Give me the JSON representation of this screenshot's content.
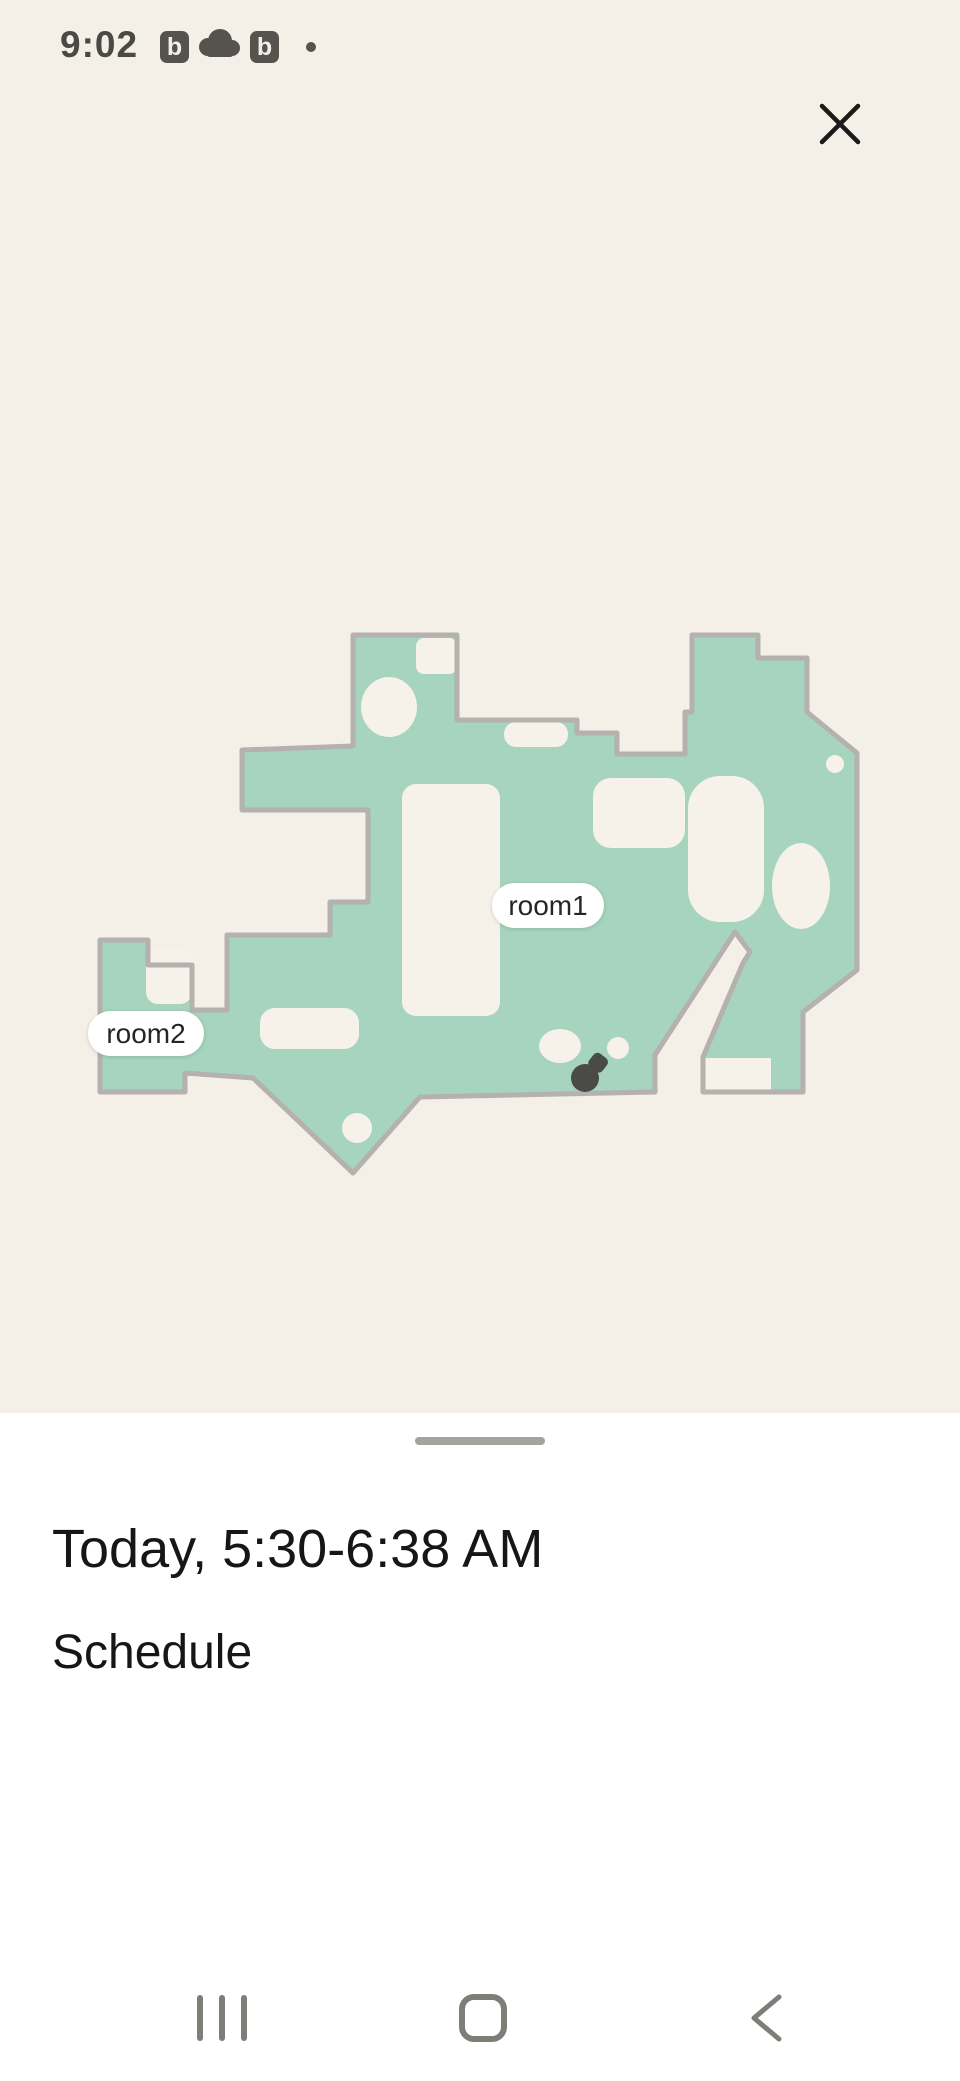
{
  "status_bar": {
    "time": "9:02",
    "badge_letter": "b",
    "wifi_generation": "6",
    "battery_percent": "93"
  },
  "map": {
    "rooms": [
      {
        "label": "room1"
      },
      {
        "label": "room2"
      }
    ],
    "colors": {
      "cleaned_area_green": "#a6d4be",
      "wall_gray": "#b4b1ae",
      "unexplored_cream": "#f6f2ea",
      "robot_dark": "#4a4a46"
    }
  },
  "sheet": {
    "title": "Today, 5:30-6:38 AM",
    "subtitle": "Schedule"
  },
  "colors": {
    "page_background": "#f4f0e7",
    "sheet_background": "#ffffff",
    "status_icon_dark": "#4b4944",
    "nav_icon_gray": "#7f7d78"
  }
}
